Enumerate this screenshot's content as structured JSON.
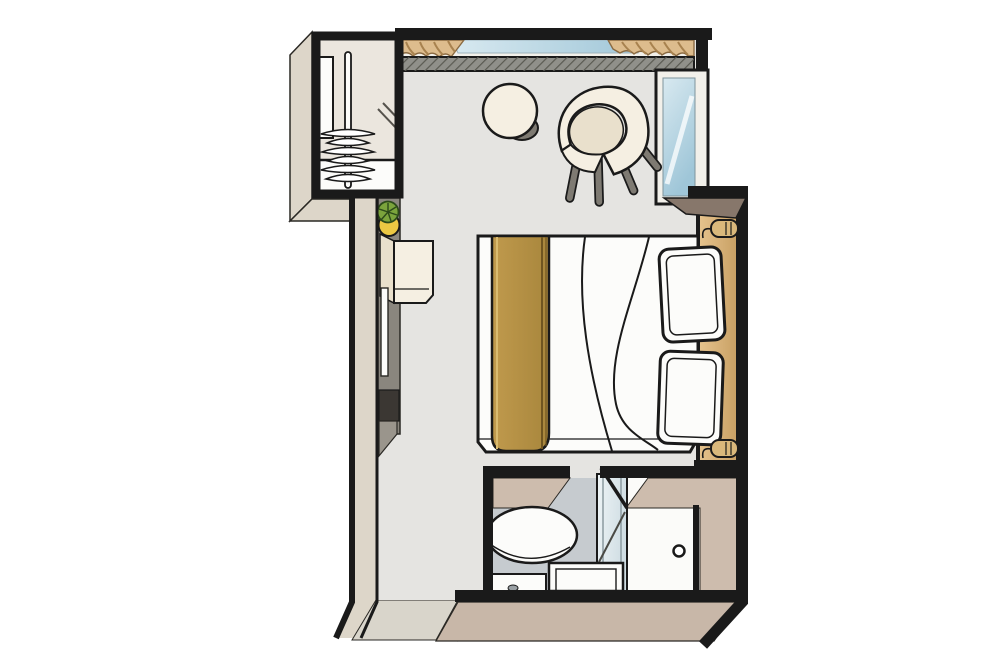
{
  "meta": {
    "type": "floor-plan",
    "subject": "cruise-ship-stateroom-cabin",
    "view": "top-down-axonometric",
    "background": "#ffffff"
  },
  "colors": {
    "outline": "#1a1a1a",
    "floor": "#e5e4e1",
    "closet_floor": "#ebe6de",
    "bath_floor": "#c6cbcf",
    "shower_tray": "#fbfbf9",
    "wall_face": "#ddd6c9",
    "threshold_face": "#d9d5cb",
    "bath_face": "#c8b7a8",
    "bath_face_inner": "#cdbcad",
    "headboard_light": "#e5c28c",
    "headboard_dark": "#c9a165",
    "step_face": "#87776b",
    "sill": "#f2f0ea",
    "glass_light": "#d8e9f0",
    "glass_dark": "#9fc6d8",
    "shower_glass_light": "#eef4f6",
    "shower_glass_dark": "#cfdde3",
    "shower_glass_line": "#8b9aa0",
    "curtain": "#ddbc8d",
    "curtain_stripe": "#a8824f",
    "curtain_edge": "#8a6a42",
    "hatch_base": "#90908a",
    "hatch_line": "#5a5a52",
    "gold_light": "#c09a4d",
    "gold_dark": "#a8863c",
    "gold_line": "#6f5520",
    "gold_highlight": "#d9bb70",
    "white_fixture": "#fcfcfa",
    "cream": "#f5efe2",
    "cream_dark": "#e9e0cc",
    "leg_gray": "#7e7a72",
    "unit_gray": "#8a867e",
    "unit_dark": "#3b3733",
    "unit_mid": "#9a958c",
    "plant_leaf": "#7ba43c",
    "plant_leaf_dark": "#2c4a1a",
    "plant_pot": "#ecc843",
    "lamp": "#d9b87b",
    "drain_gray": "#9aa0a4",
    "door_diag": "#55524c"
  },
  "objects": {
    "wardrobe": [
      "hanging-rail",
      "clothes-hangers",
      "shelf-panel",
      "drawer-box",
      "wardrobe-door"
    ],
    "living_area": [
      "panoramic-window",
      "curtain-left",
      "curtain-right",
      "window-ledge",
      "side-window",
      "round-side-table",
      "tub-armchair",
      "double-bed",
      "bed-runner",
      "pillow-top",
      "pillow-bottom",
      "headboard-panel",
      "reading-lamp-top",
      "reading-lamp-bottom",
      "wall-unit",
      "vanity-mirror",
      "minibar-cabinet",
      "potted-plant"
    ],
    "bathroom": [
      "washbasin",
      "toilet",
      "vanity-counter",
      "shower-glass-partition",
      "shower-door-knob",
      "shower-tray"
    ],
    "circulation": [
      "corridor",
      "entry-threshold",
      "bathroom-doorway"
    ]
  }
}
